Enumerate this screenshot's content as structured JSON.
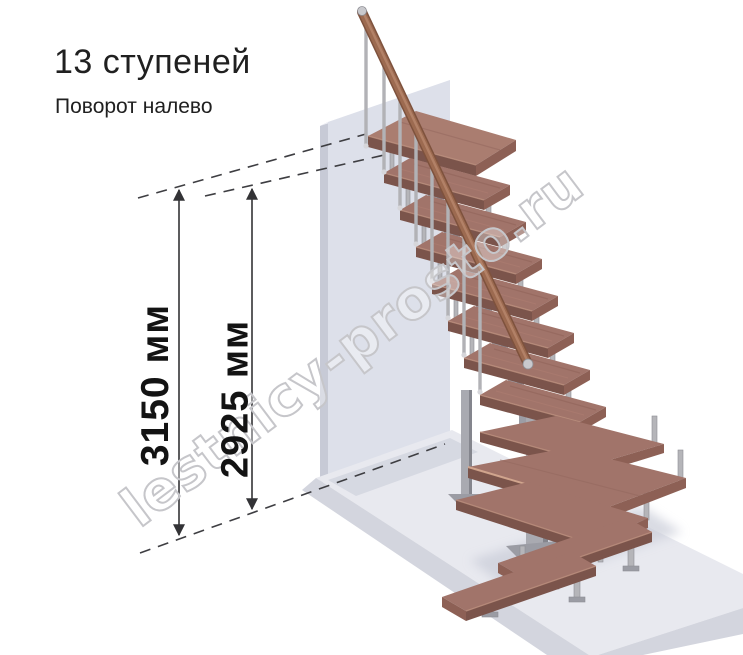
{
  "header": {
    "title": "13 ступеней",
    "subtitle": "Поворот налево"
  },
  "dimensions": {
    "total": {
      "label": "3150 мм"
    },
    "flight": {
      "label": "2925 мм"
    }
  },
  "watermark": "lestnicy-prosto.ru",
  "illustration": {
    "steps_count": 13,
    "turn_direction": "налево",
    "colors": {
      "wood": "#a1746a",
      "wood_edge": "#7b544b",
      "metal": "#b5b5b9",
      "wall": "#dde0ea",
      "floor": "#e8e9ef",
      "dimension_lines": "#3e3e42"
    }
  }
}
